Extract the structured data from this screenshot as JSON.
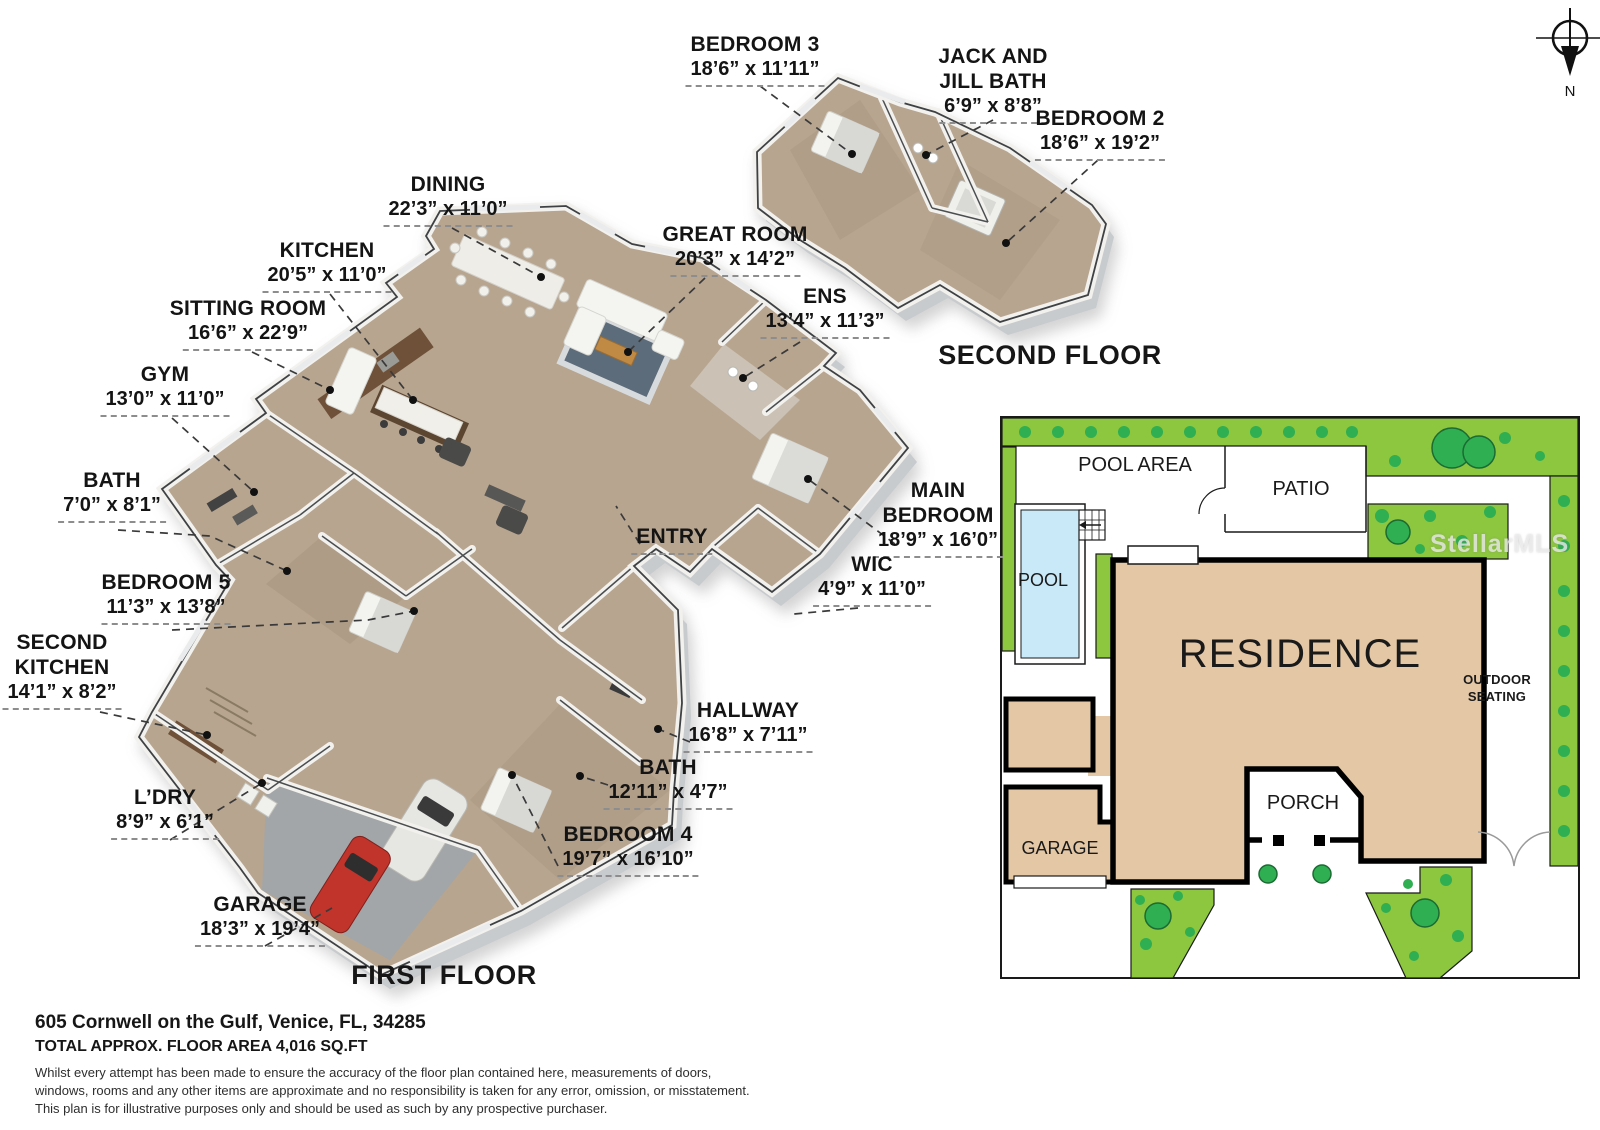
{
  "compass": {
    "north_label": "N"
  },
  "first_floor": {
    "title": "FIRST FLOOR",
    "rooms": [
      {
        "name": "DINING",
        "dims": "22’3” x 11’0”"
      },
      {
        "name": "KITCHEN",
        "dims": "20’5” x 11’0”"
      },
      {
        "name": "SITTING ROOM",
        "dims": "16’6” x 22’9”"
      },
      {
        "name": "GYM",
        "dims": "13’0” x 11’0”"
      },
      {
        "name": "GREAT ROOM",
        "dims": "20’3” x 14’2”"
      },
      {
        "name": "ENS",
        "dims": "13’4” x 11’3”"
      },
      {
        "name": "BATH",
        "dims": "7’0” x 8’1”"
      },
      {
        "name": "BEDROOM 5",
        "dims": "11’3” x 13’8”"
      },
      {
        "name": "SECOND\nKITCHEN",
        "dims": "14’1” x 8’2”"
      },
      {
        "name": "ENTRY",
        "dims": ""
      },
      {
        "name": "MAIN\nBEDROOM",
        "dims": "18’9” x 16’0”"
      },
      {
        "name": "WIC",
        "dims": "4’9” x 11’0”"
      },
      {
        "name": "HALLWAY",
        "dims": "16’8” x 7’11”"
      },
      {
        "name": "BATH",
        "dims": "12’11” x 4’7”"
      },
      {
        "name": "BEDROOM 4",
        "dims": "19’7” x 16’10”"
      },
      {
        "name": "L’DRY",
        "dims": "8’9” x 6’1”"
      },
      {
        "name": "GARAGE",
        "dims": "18’3” x 19’4”"
      }
    ]
  },
  "second_floor": {
    "title": "SECOND FLOOR",
    "rooms": [
      {
        "name": "BEDROOM 3",
        "dims": "18’6” x 11’11”"
      },
      {
        "name": "JACK AND\nJILL BATH",
        "dims": "6’9” x 8’8”"
      },
      {
        "name": "BEDROOM 2",
        "dims": "18’6” x 19’2”"
      }
    ]
  },
  "site_plan": {
    "pool_area": "POOL AREA",
    "patio": "PATIO",
    "pool": "POOL",
    "residence": "RESIDENCE",
    "outdoor_seating": "OUTDOOR\nSEATING",
    "garage": "GARAGE",
    "porch": "PORCH",
    "watermark": "StellarMLS"
  },
  "footer": {
    "address": "605 Cornwell on the Gulf, Venice, FL, 34285",
    "floor_area": "TOTAL APPROX. FLOOR AREA 4,016 SQ.FT",
    "disclaimer_lines": [
      "Whilst every attempt has been made to ensure the accuracy of the floor plan contained here, measurements of doors,",
      "windows, rooms and any other items are approximate and no responsibility is taken for any error, omission, or misstatement.",
      "This plan is for illustrative purposes only and should be used as such by any prospective purchaser."
    ]
  },
  "colors": {
    "grass": "#8dc63f",
    "tree": "#2fae52",
    "residence_fill": "#e4c7a5",
    "pool_water": "#c9e9f8",
    "floor_tan": "#b7a58f",
    "garage_floor": "#a2a6a8",
    "car_red": "#c0342c"
  }
}
